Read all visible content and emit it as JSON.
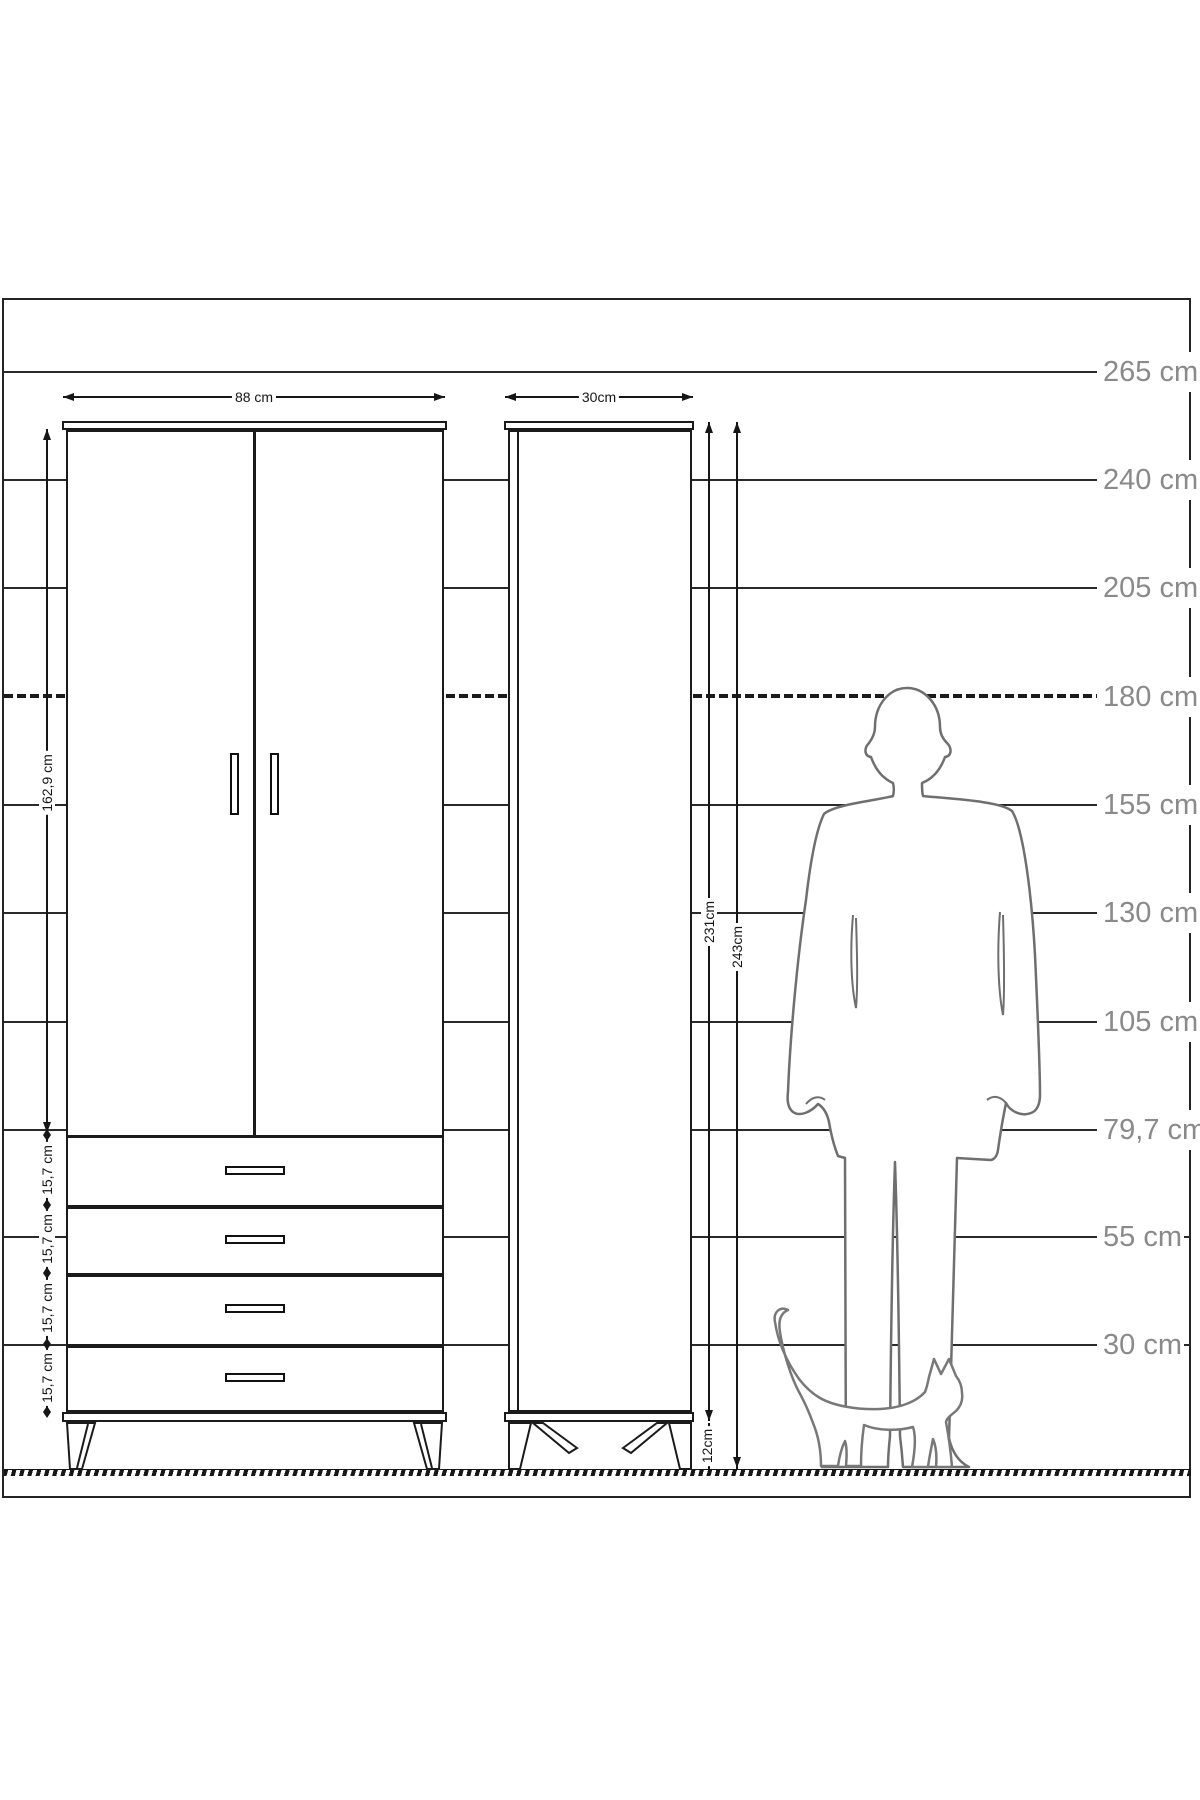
{
  "title": "wardrobe-dimension-drawing",
  "ruler": {
    "label_color": "#8a8a8a",
    "labels": [
      "265 cm",
      "240 cm",
      "205 cm",
      "180 cm",
      "155 cm",
      "130 cm",
      "105 cm",
      "79,7 cm",
      "55 cm",
      "30 cm"
    ]
  },
  "front_view": {
    "width_label": "88 cm",
    "door_height_label": "162,9 cm",
    "drawer_labels": [
      "15,7 cm",
      "15,7 cm",
      "15,7 cm",
      "15,7 cm"
    ]
  },
  "side_view": {
    "depth_label": "30cm",
    "carcass_height_label": "231cm",
    "total_height_label": "243cm",
    "leg_height_label": "12cm"
  },
  "figures": {
    "man": "man-silhouette",
    "cat": "cat-silhouette"
  },
  "colors": {
    "drawing_line": "#1b1b1b",
    "figure_outline": "#6f6f6f",
    "background": "#ffffff"
  }
}
